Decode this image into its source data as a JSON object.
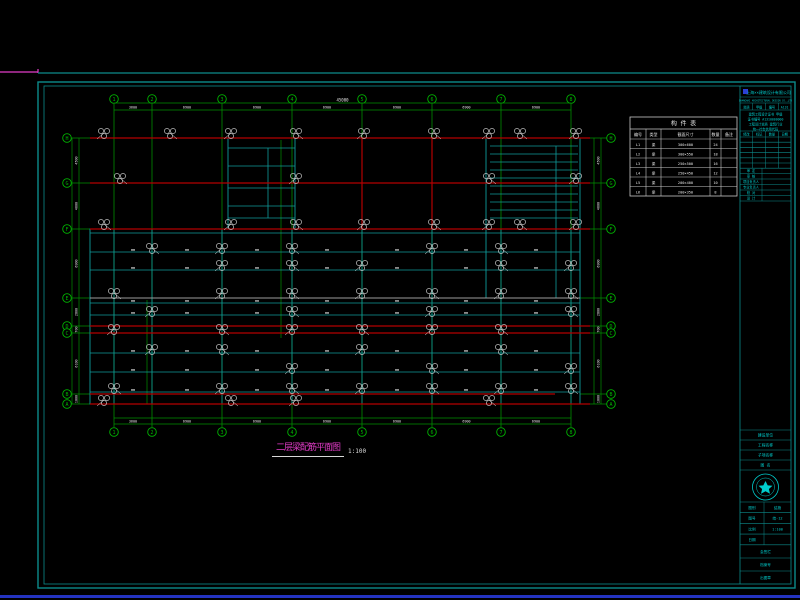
{
  "drawing_title": {
    "text": "二层梁配筋平面图",
    "scale": "1:100"
  },
  "colors": {
    "green": "#00b400",
    "dim_green": "#008f00",
    "red": "#b40000",
    "teal": "#0f9b9b",
    "gray": "#9c9c9c",
    "white": "#e6e6e6",
    "magenta": "#e23cc8",
    "cyan": "#00cccc",
    "logo_blue": "#2b3fd4",
    "frame": "#0c8b8b",
    "table_line": "#c8c8c8",
    "status_blue": "#2433c0"
  },
  "frame": {
    "top_line_y": 73,
    "magenta_seg_end": 38,
    "outer": [
      38,
      82,
      757,
      506
    ],
    "inner": [
      44,
      86,
      747,
      498
    ],
    "divider_x": 740
  },
  "axes_vertical": {
    "labels": [
      "1",
      "2",
      "3",
      "4",
      "5",
      "6",
      "7",
      "8"
    ],
    "x": [
      114,
      152,
      222,
      292,
      362,
      432,
      501,
      571
    ],
    "bubble_top_y": 99,
    "bubble_bottom_y": 432,
    "line_top": 104,
    "line_bottom": 427
  },
  "axes_horizontal": {
    "labels": [
      "H",
      "G",
      "F",
      "E",
      "D",
      "C",
      "B",
      "A"
    ],
    "y": [
      138,
      183,
      229,
      298,
      326,
      333,
      394,
      404
    ],
    "bubble_left_x": 67,
    "bubble_right_x": 611,
    "line_left": 90,
    "line_right": 580
  },
  "dimensions": {
    "top": {
      "y1": 103,
      "y2": 110,
      "total": "45000",
      "bays": [
        "3600",
        "6900",
        "6900",
        "6900",
        "6900",
        "6900",
        "6900"
      ]
    },
    "bottom": {
      "y1": 418,
      "y2": 424,
      "bays": [
        "3600",
        "6900",
        "6900",
        "6900",
        "6900",
        "6900",
        "6900"
      ]
    },
    "left": {
      "x1": 72,
      "x2": 79,
      "vals": [
        "4500",
        "4600",
        "6900",
        "2800",
        "700",
        "6100",
        "1000"
      ]
    },
    "right": {
      "x1": 594,
      "x2": 601,
      "vals": [
        "4500",
        "4600",
        "6900",
        "2800",
        "700",
        "6100",
        "1000"
      ]
    }
  },
  "plan": {
    "red_h": [
      [
        90,
        138,
        590
      ],
      [
        90,
        183,
        590
      ],
      [
        90,
        229,
        590
      ],
      [
        90,
        326,
        590
      ],
      [
        90,
        333,
        590
      ],
      [
        90,
        394,
        555
      ],
      [
        90,
        404,
        590
      ]
    ],
    "red_v": [
      [
        362,
        138,
        229
      ],
      [
        432,
        138,
        229
      ]
    ],
    "gray_h": [
      [
        90,
        298,
        580
      ]
    ],
    "teal_h": [
      [
        90,
        233,
        580
      ],
      [
        90,
        252,
        580
      ],
      [
        90,
        270,
        580
      ],
      [
        90,
        303,
        580
      ],
      [
        90,
        315,
        580
      ],
      [
        90,
        353,
        580
      ],
      [
        90,
        372,
        580
      ],
      [
        90,
        392,
        580
      ]
    ],
    "teal_rects": [
      [
        90,
        229,
        490,
        175
      ],
      [
        228,
        138,
        67,
        91
      ],
      [
        486,
        138,
        94,
        160
      ]
    ],
    "teal_v": [
      [
        114,
        229,
        404
      ],
      [
        152,
        229,
        404
      ],
      [
        222,
        229,
        404
      ],
      [
        292,
        229,
        404
      ],
      [
        362,
        229,
        404
      ],
      [
        432,
        229,
        404
      ],
      [
        501,
        229,
        404
      ],
      [
        571,
        229,
        404
      ],
      [
        268,
        148,
        218
      ],
      [
        556,
        146,
        298
      ]
    ],
    "tower_h": [
      [
        228,
        148,
        295
      ],
      [
        228,
        166,
        295
      ],
      [
        228,
        188,
        295
      ],
      [
        228,
        206,
        295
      ],
      [
        228,
        218,
        295
      ]
    ],
    "stair_rows": {
      "x1": 490,
      "x2": 578,
      "y_start": 146,
      "y_end": 218,
      "step": 8
    },
    "green_inner_v": [
      [
        281,
        140,
        338
      ],
      [
        147,
        300,
        404
      ]
    ],
    "tick_rows": {
      "y": [
        252,
        270,
        303,
        315,
        353,
        372,
        392
      ],
      "x": [
        133,
        187,
        257,
        327,
        397,
        466,
        536
      ]
    },
    "clusters": [
      [
        104,
        133
      ],
      [
        170,
        133
      ],
      [
        231,
        133
      ],
      [
        296,
        133
      ],
      [
        364,
        133
      ],
      [
        434,
        133
      ],
      [
        489,
        133
      ],
      [
        520,
        133
      ],
      [
        576,
        133
      ],
      [
        120,
        178
      ],
      [
        296,
        178
      ],
      [
        489,
        178
      ],
      [
        576,
        178
      ],
      [
        104,
        224
      ],
      [
        231,
        224
      ],
      [
        296,
        224
      ],
      [
        364,
        224
      ],
      [
        434,
        224
      ],
      [
        489,
        224
      ],
      [
        520,
        224
      ],
      [
        576,
        224
      ],
      [
        152,
        248
      ],
      [
        222,
        248
      ],
      [
        292,
        248
      ],
      [
        432,
        248
      ],
      [
        501,
        248
      ],
      [
        222,
        265
      ],
      [
        292,
        265
      ],
      [
        362,
        265
      ],
      [
        501,
        265
      ],
      [
        571,
        265
      ],
      [
        114,
        293
      ],
      [
        222,
        293
      ],
      [
        292,
        293
      ],
      [
        362,
        293
      ],
      [
        432,
        293
      ],
      [
        501,
        293
      ],
      [
        571,
        293
      ],
      [
        152,
        311
      ],
      [
        292,
        311
      ],
      [
        432,
        311
      ],
      [
        571,
        311
      ],
      [
        114,
        329
      ],
      [
        222,
        329
      ],
      [
        292,
        329
      ],
      [
        362,
        329
      ],
      [
        432,
        329
      ],
      [
        501,
        329
      ],
      [
        152,
        349
      ],
      [
        222,
        349
      ],
      [
        362,
        349
      ],
      [
        501,
        349
      ],
      [
        292,
        368
      ],
      [
        432,
        368
      ],
      [
        571,
        368
      ],
      [
        114,
        388
      ],
      [
        222,
        388
      ],
      [
        292,
        388
      ],
      [
        362,
        388
      ],
      [
        432,
        388
      ],
      [
        501,
        388
      ],
      [
        571,
        388
      ],
      [
        104,
        400
      ],
      [
        231,
        400
      ],
      [
        296,
        400
      ],
      [
        489,
        400
      ]
    ]
  },
  "member_table": {
    "x": 630,
    "y": 117,
    "w": 107,
    "h": 79,
    "title": "构 件 表",
    "col_widths": [
      16,
      15,
      49,
      11,
      16
    ],
    "headers": [
      "编号",
      "类型",
      "截面尺寸",
      "数量",
      "备注"
    ],
    "rows": [
      [
        "L1",
        "梁",
        "300×600",
        "24",
        ""
      ],
      [
        "L2",
        "梁",
        "300×550",
        "18",
        ""
      ],
      [
        "L3",
        "梁",
        "250×500",
        "16",
        ""
      ],
      [
        "L4",
        "梁",
        "250×450",
        "12",
        ""
      ],
      [
        "L5",
        "梁",
        "200×400",
        "10",
        ""
      ],
      [
        "L6",
        "梁",
        "200×350",
        "8",
        ""
      ]
    ]
  },
  "title_block": {
    "company": "上海××建筑设计有限公司",
    "subtext": "SHANGHAI ARCHITECTURAL DESIGN CO.,LTD",
    "cert_cells": [
      "资质",
      "甲级",
      "编号",
      "A131"
    ],
    "cert_lines": [
      "建筑工程设计证书 甲级",
      "证书编号 A1310000000",
      "工程设计资质 建筑行业",
      "统一社会信用代码"
    ],
    "rev_table": {
      "headers": [
        "修改",
        "标记",
        "数量",
        "日期"
      ],
      "empty_rows": 6
    },
    "sign_rows": [
      "审 定",
      "审 核",
      "项目负责人",
      "专业负责人",
      "校 对",
      "设 计"
    ],
    "info_rows": [
      "建设单位",
      "工程名称",
      "子项名称",
      "图 名"
    ],
    "meta_rows": [
      [
        "图别",
        "结施"
      ],
      [
        "图号",
        "结-12"
      ],
      [
        "比例",
        "1:100"
      ],
      [
        "日期",
        ""
      ]
    ],
    "bottom_rows": [
      "会签栏",
      "档案号",
      "出图章"
    ]
  }
}
